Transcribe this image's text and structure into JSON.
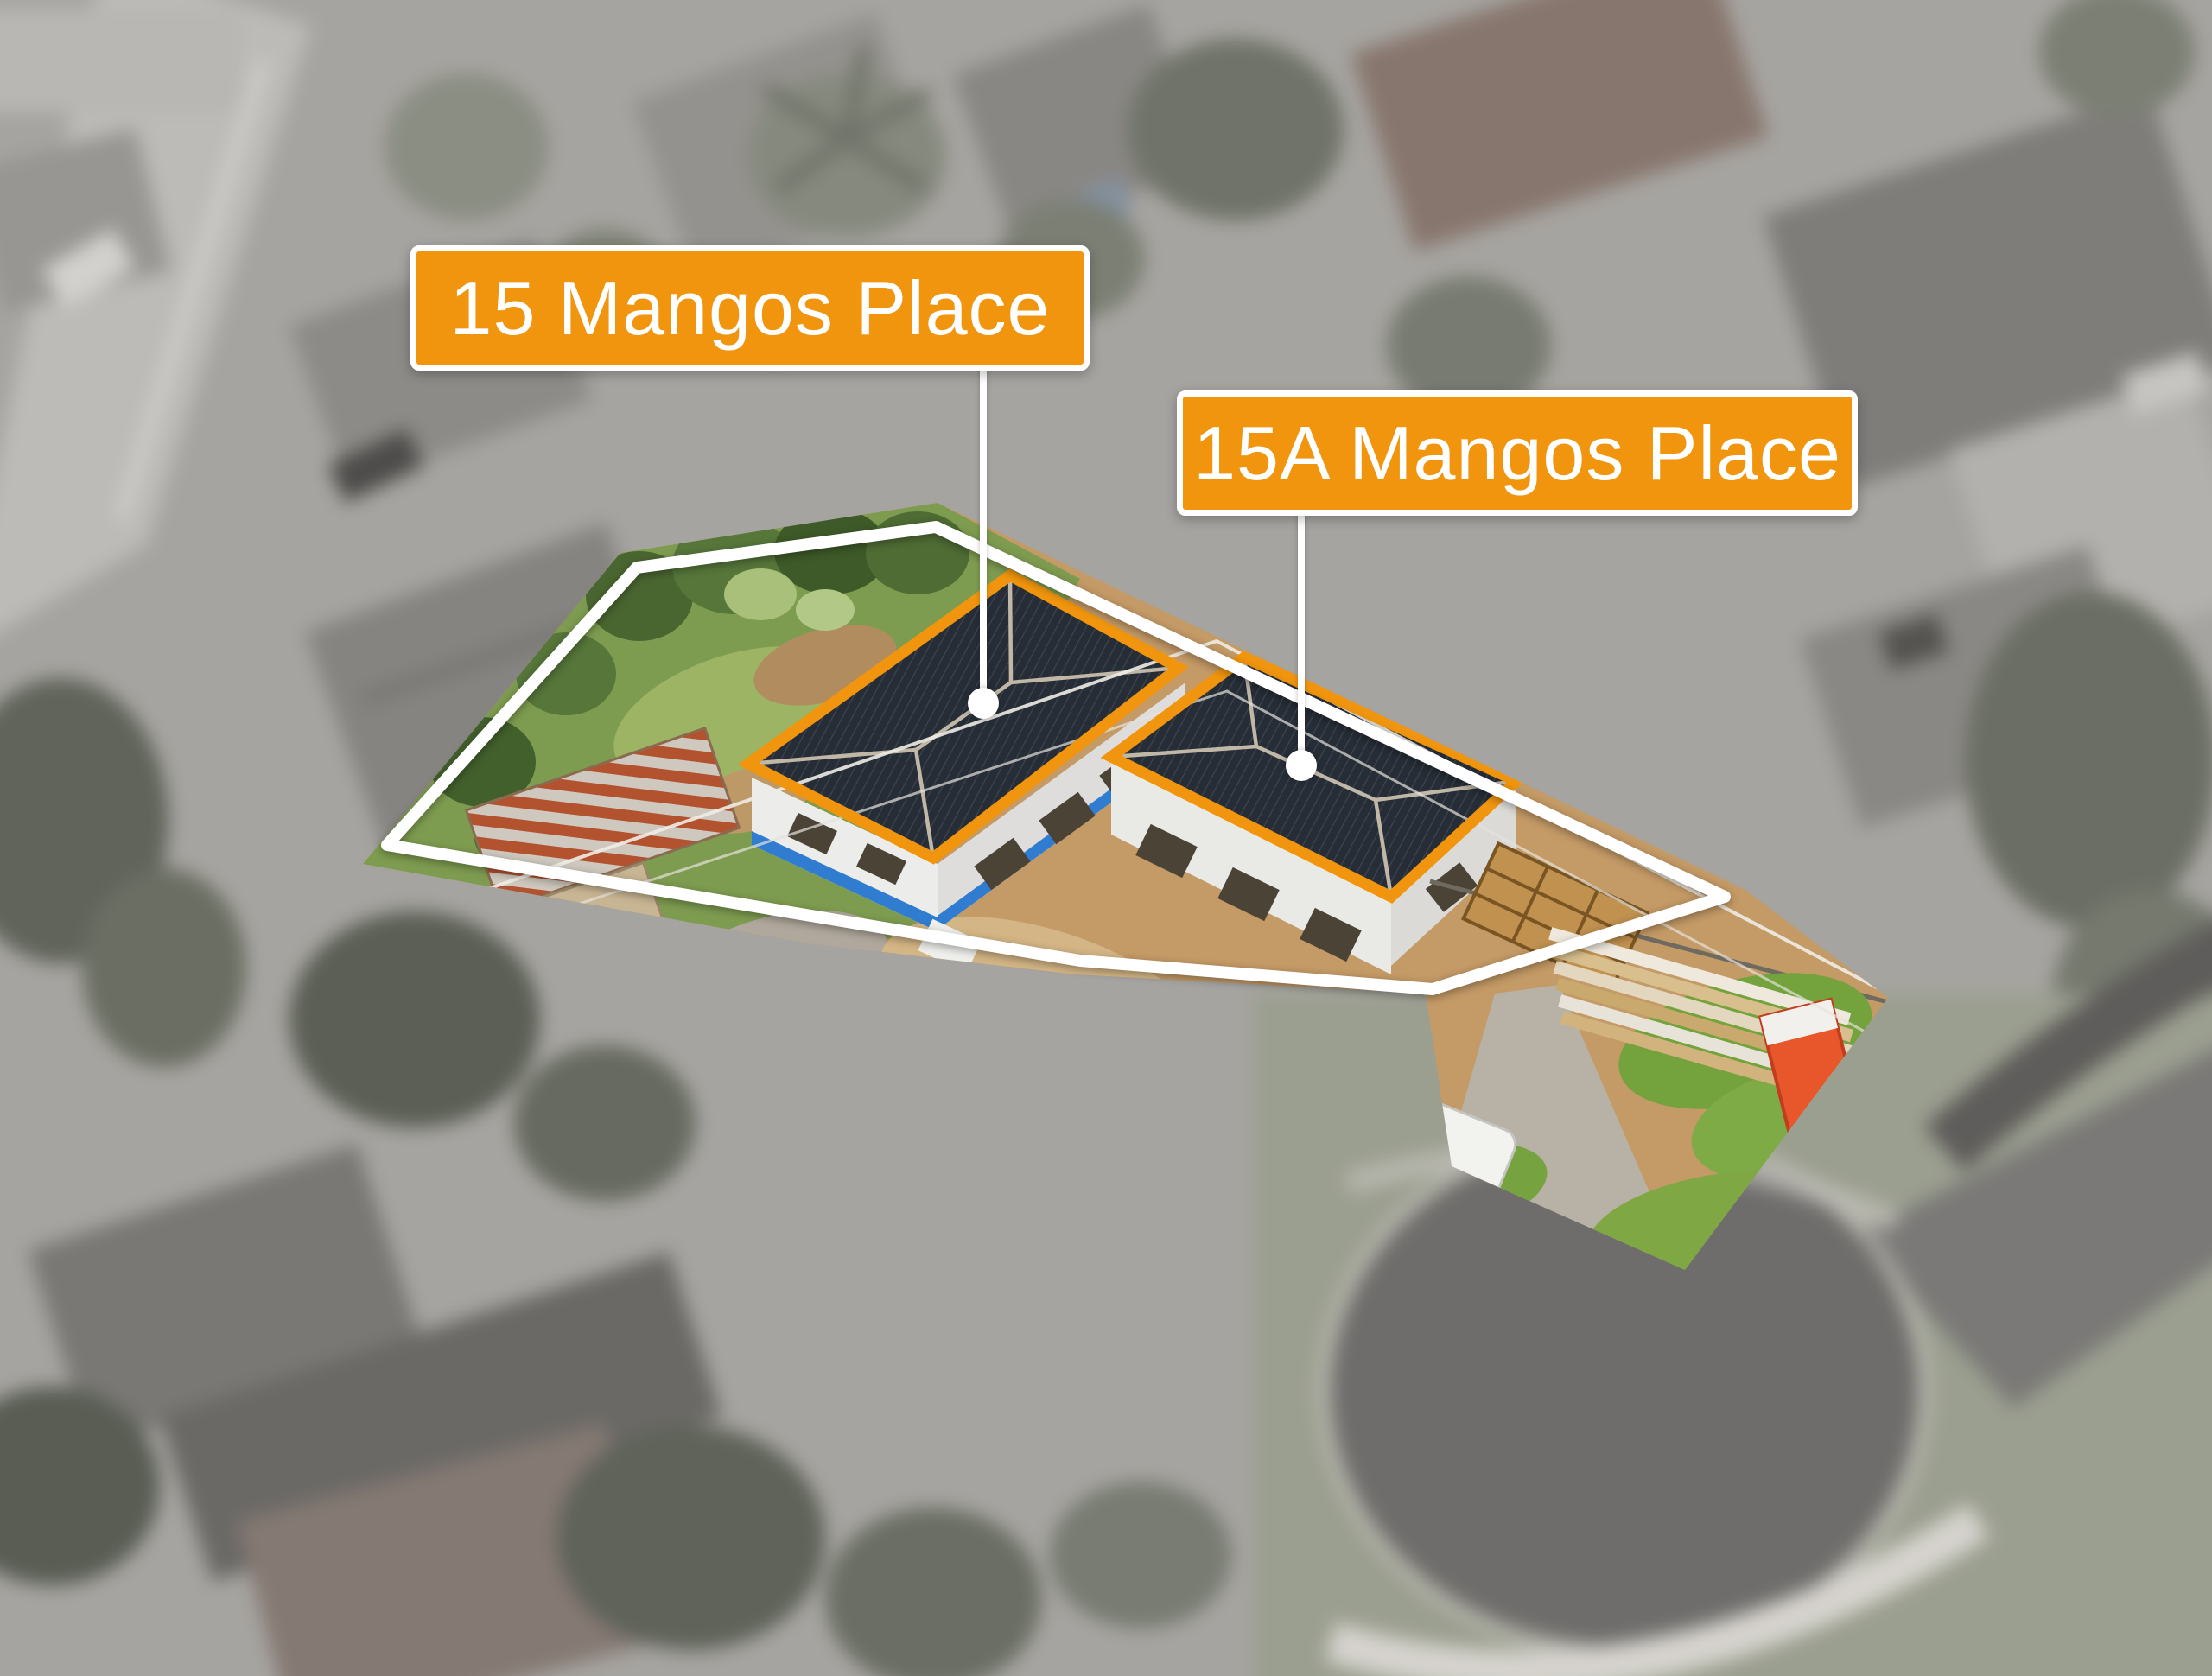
{
  "callouts": [
    {
      "text": "15 Mangos Place"
    },
    {
      "text": "15A Mangos Place"
    }
  ],
  "colors": {
    "accent_orange": "#f0950d",
    "boundary_white": "#ffffff",
    "roof_dark_navy": "#262d36",
    "roof_ridge": "#c0b7a7",
    "house_wall_white": "#ececea",
    "waterproof_blue": "#2f7cd0",
    "garden_green": "#7e9c50",
    "dirt_tan": "#c49a66",
    "rust_red": "#b3522f",
    "portaloo_orange": "#e8562c",
    "background_gray": "#a7a49f",
    "asphalt_dark": "#6f6d6a"
  }
}
